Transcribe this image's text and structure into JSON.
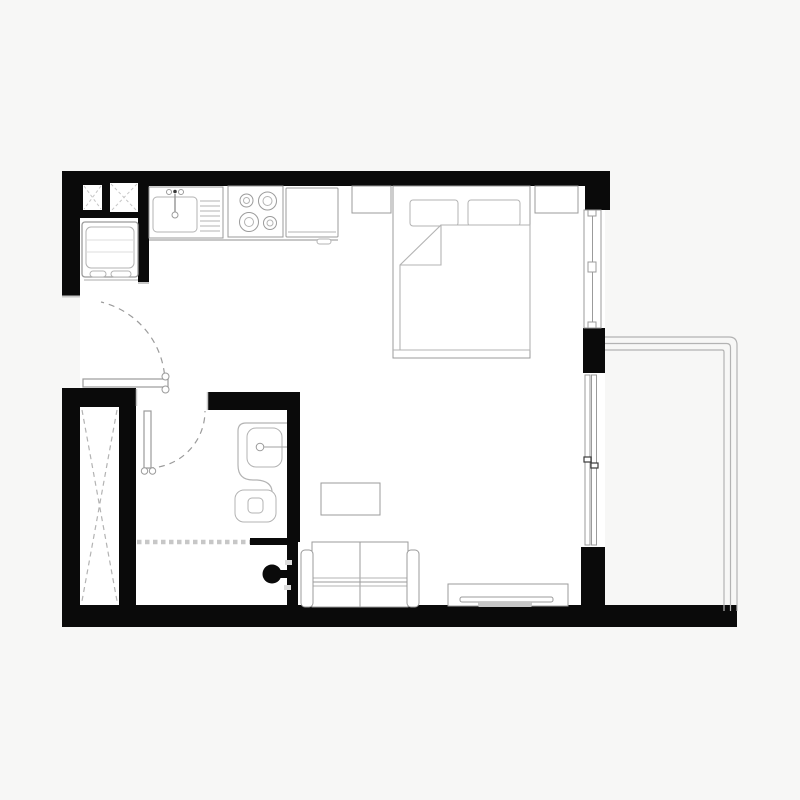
{
  "title": "studio-apartment-floor-plan",
  "canvas": {
    "w": 800,
    "h": 800
  },
  "palette": {
    "bg": "#f7f7f6",
    "floor": "#ffffff",
    "wall": "#0a0a0a",
    "stroke": "#9b9b9b",
    "stroke2": "#b3b3b3",
    "light": "#c7c7c7",
    "faint": "#dcdcdc",
    "dark": "#3a3a3a"
  },
  "shapes": [
    {
      "n": "apartment-floor",
      "t": "rect",
      "x": 80,
      "y": 186,
      "w": 525,
      "h": 421,
      "f": "floor"
    },
    {
      "n": "wall-top",
      "t": "rect",
      "x": 62,
      "y": 171,
      "w": 548,
      "h": 15,
      "f": "wall"
    },
    {
      "n": "wall-top-left-block",
      "t": "rect",
      "x": 62,
      "y": 171,
      "w": 87,
      "h": 47,
      "f": "wall"
    },
    {
      "n": "wall-left-upper",
      "t": "rect",
      "x": 62,
      "y": 171,
      "w": 18,
      "h": 125,
      "f": "wall"
    },
    {
      "n": "wall-fridge-niche",
      "t": "rect",
      "x": 138,
      "y": 171,
      "w": 11,
      "h": 112,
      "f": "wall"
    },
    {
      "n": "wall-left-lower",
      "t": "rect",
      "x": 62,
      "y": 388,
      "w": 18,
      "h": 239,
      "f": "wall"
    },
    {
      "n": "wall-entry-stub",
      "t": "rect",
      "x": 62,
      "y": 388,
      "w": 74,
      "h": 19,
      "f": "wall"
    },
    {
      "n": "wall-closet-right",
      "t": "rect",
      "x": 119,
      "y": 407,
      "w": 17,
      "h": 220,
      "f": "wall"
    },
    {
      "n": "wall-bottom",
      "t": "rect",
      "x": 62,
      "y": 605,
      "w": 675,
      "h": 22,
      "f": "wall"
    },
    {
      "n": "wall-bathroom-top",
      "t": "rect",
      "x": 207,
      "y": 392,
      "w": 93,
      "h": 18,
      "f": "wall"
    },
    {
      "n": "wall-bathroom-right",
      "t": "rect",
      "x": 287,
      "y": 392,
      "w": 13,
      "h": 150,
      "f": "wall"
    },
    {
      "n": "wall-bathroom-stub",
      "t": "rect",
      "x": 250,
      "y": 538,
      "w": 48,
      "h": 7,
      "f": "wall"
    },
    {
      "n": "wall-bathroom-lower",
      "t": "rect",
      "x": 287,
      "y": 540,
      "w": 11,
      "h": 87,
      "f": "wall"
    },
    {
      "n": "wall-window-pier-top",
      "t": "rect",
      "x": 585,
      "y": 171,
      "w": 25,
      "h": 39,
      "f": "wall"
    },
    {
      "n": "wall-window-pier-middle",
      "t": "rect",
      "x": 583,
      "y": 328,
      "w": 22,
      "h": 45,
      "f": "wall"
    },
    {
      "n": "wall-window-pier-bottom",
      "t": "rect",
      "x": 581,
      "y": 547,
      "w": 24,
      "h": 60,
      "f": "wall"
    },
    {
      "n": "duct-shaft-small",
      "t": "rect",
      "x": 83,
      "y": 185,
      "w": 19,
      "h": 25,
      "f": "floor"
    },
    {
      "n": "duct-shaft-small-x1",
      "t": "line",
      "x1": 84,
      "y1": 186,
      "x2": 101,
      "y2": 209,
      "s": "light",
      "dash": "3 2.5"
    },
    {
      "n": "duct-shaft-small-x2",
      "t": "line",
      "x1": 101,
      "y1": 186,
      "x2": 84,
      "y2": 209,
      "s": "light",
      "dash": "3 2.5"
    },
    {
      "n": "duct-shaft-large",
      "t": "rect",
      "x": 110,
      "y": 183,
      "w": 28,
      "h": 29,
      "f": "floor"
    },
    {
      "n": "duct-shaft-large-x1",
      "t": "line",
      "x1": 111,
      "y1": 184,
      "x2": 137,
      "y2": 211,
      "s": "light",
      "dash": "3 2.5"
    },
    {
      "n": "duct-shaft-large-x2",
      "t": "line",
      "x1": 137,
      "y1": 184,
      "x2": 111,
      "y2": 211,
      "s": "light",
      "dash": "3 2.5"
    },
    {
      "n": "wall-cap-entry-top",
      "t": "line",
      "x1": 62,
      "y1": 296.5,
      "x2": 80,
      "y2": 296.5,
      "s": "light",
      "sw": 2
    },
    {
      "n": "wall-cap-fridge-niche",
      "t": "line",
      "x1": 138,
      "y1": 283,
      "x2": 149,
      "y2": 283,
      "s": "light",
      "sw": 2
    },
    {
      "n": "wall-cap-bathroom",
      "t": "line",
      "x1": 207.5,
      "y1": 392,
      "x2": 207.5,
      "y2": 410,
      "s": "light",
      "sw": 1.5
    },
    {
      "n": "wall-cap-entry-stub",
      "t": "line",
      "x1": 136.5,
      "y1": 389,
      "x2": 136.5,
      "y2": 406,
      "s": "light",
      "sw": 1.5
    },
    {
      "n": "closet-x-line-1",
      "t": "line",
      "x1": 82,
      "y1": 410,
      "x2": 117,
      "y2": 601,
      "s": "stroke2",
      "dash": "5 4",
      "sw": 1.2
    },
    {
      "n": "closet-x-line-2",
      "t": "line",
      "x1": 117,
      "y1": 410,
      "x2": 82,
      "y2": 601,
      "s": "stroke2",
      "dash": "5 4",
      "sw": 1.2
    },
    {
      "n": "counter-shadow",
      "t": "line",
      "x1": 149,
      "y1": 240,
      "x2": 338,
      "y2": 240,
      "s": "light",
      "sw": 2
    },
    {
      "n": "kitchen-sink-unit",
      "t": "rect",
      "x": 149,
      "y": 187,
      "w": 74,
      "h": 51,
      "f": "floor",
      "s": "stroke"
    },
    {
      "n": "sink-basin",
      "t": "rect",
      "x": 153,
      "y": 197,
      "w": 44,
      "h": 35,
      "rx": 4,
      "s": "stroke2",
      "f": "none"
    },
    {
      "n": "sink-drainboard",
      "t": "hatch",
      "x": 200,
      "y": 196,
      "w": 20,
      "h": 37,
      "step": 5,
      "s": "stroke2"
    },
    {
      "n": "faucet-handle-left",
      "t": "circle",
      "cx": 169,
      "cy": 192,
      "r": 2.5,
      "s": "stroke",
      "f": "none"
    },
    {
      "n": "faucet-dot",
      "t": "circle",
      "cx": 175,
      "cy": 191.5,
      "r": 1.8,
      "f": "dark"
    },
    {
      "n": "faucet-handle-right",
      "t": "circle",
      "cx": 181,
      "cy": 192,
      "r": 2.5,
      "s": "stroke",
      "f": "none"
    },
    {
      "n": "faucet-stem",
      "t": "line",
      "x1": 175,
      "y1": 194,
      "x2": 175,
      "y2": 212,
      "s": "stroke",
      "sw": 1.5
    },
    {
      "n": "faucet-spout",
      "t": "circle",
      "cx": 175,
      "cy": 215,
      "r": 3,
      "s": "stroke",
      "f": "none"
    },
    {
      "n": "stove",
      "t": "rect",
      "x": 228,
      "y": 186,
      "w": 55,
      "h": 51,
      "f": "floor",
      "s": "stroke"
    },
    {
      "n": "burner-1-outer",
      "t": "circle",
      "cx": 246.5,
      "cy": 200.5,
      "r": 6.5,
      "s": "stroke",
      "f": "none"
    },
    {
      "n": "burner-1-inner",
      "t": "circle",
      "cx": 246.5,
      "cy": 200.5,
      "r": 3,
      "s": "stroke2",
      "f": "none"
    },
    {
      "n": "burner-2-outer",
      "t": "circle",
      "cx": 267.5,
      "cy": 201,
      "r": 9,
      "s": "stroke",
      "f": "none"
    },
    {
      "n": "burner-2-inner",
      "t": "circle",
      "cx": 267.5,
      "cy": 201,
      "r": 4.5,
      "s": "stroke2",
      "f": "none"
    },
    {
      "n": "burner-3-outer",
      "t": "circle",
      "cx": 249,
      "cy": 222,
      "r": 9.5,
      "s": "stroke",
      "f": "none"
    },
    {
      "n": "burner-3-inner",
      "t": "circle",
      "cx": 249,
      "cy": 222,
      "r": 4.5,
      "s": "stroke2",
      "f": "none"
    },
    {
      "n": "burner-4-outer",
      "t": "circle",
      "cx": 270,
      "cy": 223,
      "r": 6.5,
      "s": "stroke",
      "f": "none"
    },
    {
      "n": "burner-4-inner",
      "t": "circle",
      "cx": 270,
      "cy": 223,
      "r": 3,
      "s": "stroke2",
      "f": "none"
    },
    {
      "n": "oven",
      "t": "rect",
      "x": 286,
      "y": 188,
      "w": 52,
      "h": 49,
      "rx": 1,
      "f": "floor",
      "s": "stroke"
    },
    {
      "n": "oven-handle-line",
      "t": "line",
      "x1": 288,
      "y1": 232,
      "x2": 336,
      "y2": 232,
      "s": "stroke2"
    },
    {
      "n": "oven-handle",
      "t": "rect",
      "x": 317,
      "y": 239,
      "w": 14,
      "h": 5,
      "rx": 2.5,
      "f": "floor",
      "s": "stroke2"
    },
    {
      "n": "fridge",
      "t": "rect",
      "x": 82,
      "y": 222,
      "w": 56,
      "h": 55,
      "rx": 3,
      "f": "floor",
      "s": "stroke",
      "sw": 1.3
    },
    {
      "n": "fridge-inner",
      "t": "rect",
      "x": 86,
      "y": 227,
      "w": 48,
      "h": 41,
      "rx": 5,
      "s": "stroke2",
      "f": "none"
    },
    {
      "n": "fridge-shelf-line-1",
      "t": "line",
      "x1": 86,
      "y1": 240,
      "x2": 134,
      "y2": 240,
      "s": "faint"
    },
    {
      "n": "fridge-shelf-line-2",
      "t": "line",
      "x1": 86,
      "y1": 252,
      "x2": 134,
      "y2": 252,
      "s": "faint"
    },
    {
      "n": "fridge-handle-1",
      "t": "rect",
      "x": 90,
      "y": 271,
      "w": 16,
      "h": 6,
      "rx": 3,
      "s": "stroke2",
      "f": "floor"
    },
    {
      "n": "fridge-handle-2",
      "t": "rect",
      "x": 111,
      "y": 271,
      "w": 20,
      "h": 6,
      "rx": 3,
      "s": "stroke2",
      "f": "floor"
    },
    {
      "n": "fridge-shadow",
      "t": "line",
      "x1": 84,
      "y1": 280,
      "x2": 138,
      "y2": 280,
      "s": "light",
      "sw": 1.5
    },
    {
      "n": "entry-door-swing-arc",
      "t": "path",
      "d": "M 165,385 A 84 84 0 0 0 101,302",
      "s": "stroke",
      "dash": "6 5",
      "sw": 1.2,
      "f": "none"
    },
    {
      "n": "entry-door-leaf",
      "t": "rect",
      "x": 83,
      "y": 379,
      "w": 85,
      "h": 8,
      "f": "floor",
      "s": "stroke",
      "sw": 1.2
    },
    {
      "n": "entry-door-hinge-top",
      "t": "circle",
      "cx": 165.5,
      "cy": 376.5,
      "r": 3.5,
      "f": "floor",
      "s": "stroke"
    },
    {
      "n": "entry-door-hinge-bottom",
      "t": "circle",
      "cx": 165.5,
      "cy": 389.5,
      "r": 3.5,
      "f": "floor",
      "s": "stroke"
    },
    {
      "n": "bathroom-door-swing-arc",
      "t": "path",
      "d": "M 148,468 A 57 57 0 0 0 205,411",
      "s": "stroke",
      "dash": "6 5",
      "sw": 1.2,
      "f": "none"
    },
    {
      "n": "bathroom-door-leaf",
      "t": "rect",
      "x": 144,
      "y": 411,
      "w": 7,
      "h": 57,
      "f": "floor",
      "s": "stroke",
      "sw": 1.2
    },
    {
      "n": "bathroom-door-hinge-left",
      "t": "circle",
      "cx": 144.5,
      "cy": 471,
      "r": 3.2,
      "f": "floor",
      "s": "stroke"
    },
    {
      "n": "bathroom-door-hinge-right",
      "t": "circle",
      "cx": 152.5,
      "cy": 471,
      "r": 3.2,
      "f": "floor",
      "s": "stroke"
    },
    {
      "n": "vanity-counter",
      "t": "path",
      "d": "M 287,423 L 246,423 Q 238,423 238,431 L 238,465 Q 238,480 253,480 L 257,480 Q 271,481 272,491 L 272,500",
      "s": "stroke2",
      "sw": 1.2,
      "f": "none"
    },
    {
      "n": "vanity-basin",
      "t": "rect",
      "x": 247,
      "y": 428,
      "w": 35,
      "h": 39,
      "rx": 9,
      "s": "stroke2",
      "f": "none"
    },
    {
      "n": "vanity-faucet",
      "t": "circle",
      "cx": 260,
      "cy": 447,
      "r": 3.8,
      "s": "stroke",
      "f": "none"
    },
    {
      "n": "vanity-faucet-line",
      "t": "line",
      "x1": 264,
      "y1": 447,
      "x2": 287,
      "y2": 447,
      "s": "stroke2",
      "sw": 1.2
    },
    {
      "n": "toilet-bowl",
      "t": "rect",
      "x": 235,
      "y": 490,
      "w": 41,
      "h": 32,
      "rx": 9,
      "f": "floor",
      "s": "stroke2"
    },
    {
      "n": "toilet-flush",
      "t": "rect",
      "x": 248,
      "y": 498,
      "w": 15,
      "h": 15,
      "rx": 4,
      "s": "stroke2",
      "f": "none"
    },
    {
      "n": "shower-screen",
      "t": "line",
      "x1": 137,
      "y1": 542,
      "x2": 250,
      "y2": 542,
      "s": "light",
      "sw": 4.5,
      "dash": "4.5 3.5"
    },
    {
      "n": "door-pull-knob",
      "t": "circle",
      "cx": 272,
      "cy": 574,
      "r": 9.5,
      "f": "wall"
    },
    {
      "n": "door-pull-stem",
      "t": "rect",
      "x": 279,
      "y": 570,
      "w": 10,
      "h": 8,
      "f": "wall"
    },
    {
      "n": "door-pull-mark-top",
      "t": "rect",
      "x": 285,
      "y": 560,
      "w": 7,
      "h": 5,
      "f": "faint"
    },
    {
      "n": "door-pull-mark-bottom",
      "t": "rect",
      "x": 284,
      "y": 585,
      "w": 7,
      "h": 5,
      "f": "faint"
    },
    {
      "n": "coffee-table",
      "t": "rect",
      "x": 321,
      "y": 483,
      "w": 59,
      "h": 32,
      "f": "floor",
      "s": "stroke"
    },
    {
      "n": "sofa-body",
      "t": "rect",
      "x": 312,
      "y": 542,
      "w": 96,
      "h": 65,
      "f": "floor",
      "s": "stroke"
    },
    {
      "n": "sofa-seat-divider",
      "t": "line",
      "x1": 360,
      "y1": 542,
      "x2": 360,
      "y2": 607,
      "s": "stroke"
    },
    {
      "n": "sofa-seat-line-1",
      "t": "line",
      "x1": 312,
      "y1": 578,
      "x2": 408,
      "y2": 578,
      "s": "stroke2"
    },
    {
      "n": "sofa-seat-line-2",
      "t": "line",
      "x1": 312,
      "y1": 582,
      "x2": 408,
      "y2": 582,
      "s": "stroke"
    },
    {
      "n": "sofa-seat-line-3",
      "t": "line",
      "x1": 312,
      "y1": 586,
      "x2": 408,
      "y2": 586,
      "s": "stroke2"
    },
    {
      "n": "sofa-armrest-left",
      "t": "rect",
      "x": 301,
      "y": 550,
      "w": 12,
      "h": 57,
      "rx": 4,
      "f": "floor",
      "s": "stroke"
    },
    {
      "n": "sofa-armrest-right",
      "t": "rect",
      "x": 407,
      "y": 550,
      "w": 12,
      "h": 57,
      "rx": 4,
      "f": "floor",
      "s": "stroke"
    },
    {
      "n": "tv-console",
      "t": "rect",
      "x": 448,
      "y": 584,
      "w": 120,
      "h": 22,
      "f": "floor",
      "s": "stroke"
    },
    {
      "n": "tv-screen",
      "t": "rect",
      "x": 460,
      "y": 597,
      "w": 93,
      "h": 5,
      "rx": 2,
      "f": "floor",
      "s": "stroke"
    },
    {
      "n": "tv-stand",
      "t": "rect",
      "x": 478,
      "y": 602,
      "w": 54,
      "h": 5,
      "rx": 1.5,
      "f": "light"
    },
    {
      "n": "bed-frame",
      "t": "rect",
      "x": 393,
      "y": 186,
      "w": 137,
      "h": 172,
      "f": "floor",
      "s": "stroke"
    },
    {
      "n": "pillow-1",
      "t": "rect",
      "x": 410,
      "y": 200,
      "w": 48,
      "h": 26,
      "rx": 3,
      "f": "floor",
      "s": "stroke2"
    },
    {
      "n": "pillow-2",
      "t": "rect",
      "x": 468,
      "y": 200,
      "w": 52,
      "h": 26,
      "rx": 3,
      "f": "floor",
      "s": "stroke2"
    },
    {
      "n": "bed-blanket",
      "t": "path",
      "d": "M 441,225 L 530,225 L 530,350 L 400,350 L 400,265 L 441,265 Z",
      "f": "floor",
      "s": "stroke2",
      "sw": 1.1
    },
    {
      "n": "blanket-fold",
      "t": "path",
      "d": "M 441,225 L 400,265",
      "s": "stroke2",
      "sw": 1.1,
      "f": "none"
    },
    {
      "n": "bed-foot-line",
      "t": "line",
      "x1": 393,
      "y1": 350,
      "x2": 530,
      "y2": 350,
      "s": "stroke2"
    },
    {
      "n": "nightstand-left",
      "t": "rect",
      "x": 352,
      "y": 186,
      "w": 39,
      "h": 27,
      "f": "floor",
      "s": "stroke"
    },
    {
      "n": "nightstand-right",
      "t": "rect",
      "x": 535,
      "y": 186,
      "w": 43,
      "h": 27,
      "f": "floor",
      "s": "stroke"
    },
    {
      "n": "window-bedroom",
      "t": "rect",
      "x": 584,
      "y": 210,
      "w": 17,
      "h": 118,
      "f": "floor",
      "s": "stroke"
    },
    {
      "n": "window-bedroom-glass",
      "t": "line",
      "x1": 592.5,
      "y1": 210,
      "x2": 592.5,
      "y2": 328,
      "s": "stroke"
    },
    {
      "n": "window-mullion-top",
      "t": "rect",
      "x": 588,
      "y": 210,
      "w": 8,
      "h": 6,
      "f": "floor",
      "s": "stroke"
    },
    {
      "n": "window-mullion-middle",
      "t": "rect",
      "x": 588,
      "y": 262,
      "w": 8,
      "h": 10,
      "f": "floor",
      "s": "stroke"
    },
    {
      "n": "window-mullion-bottom",
      "t": "rect",
      "x": 588,
      "y": 322,
      "w": 8,
      "h": 6,
      "f": "floor",
      "s": "stroke"
    },
    {
      "n": "slider-door-track-left",
      "t": "rect",
      "x": 585,
      "y": 375,
      "w": 5,
      "h": 170,
      "f": "floor",
      "s": "stroke"
    },
    {
      "n": "slider-door-track-right",
      "t": "rect",
      "x": 591.5,
      "y": 375,
      "w": 5,
      "h": 170,
      "f": "floor",
      "s": "stroke"
    },
    {
      "n": "slider-door-handle-left",
      "t": "rect",
      "x": 584,
      "y": 457,
      "w": 7,
      "h": 5,
      "f": "floor",
      "s": "dark",
      "sw": 1.2
    },
    {
      "n": "slider-door-handle-right",
      "t": "rect",
      "x": 591,
      "y": 463,
      "w": 7,
      "h": 5,
      "f": "floor",
      "s": "dark",
      "sw": 1.2
    },
    {
      "n": "balcony-railing-outer",
      "t": "path",
      "d": "M 605,337 L 729,337 Q 737,337 737,345 L 737,611",
      "s": "stroke2",
      "sw": 1.2,
      "f": "none"
    },
    {
      "n": "balcony-railing-middle",
      "t": "path",
      "d": "M 605,343.5 L 726.5,343.5 Q 730.5,343.5 730.5,347.5 L 730.5,611",
      "s": "stroke2",
      "sw": 1.2,
      "f": "none"
    },
    {
      "n": "balcony-railing-inner",
      "t": "path",
      "d": "M 605,350 L 722,350 Q 724,350 724,352 L 724,611",
      "s": "stroke2",
      "sw": 1.2,
      "f": "none"
    }
  ]
}
